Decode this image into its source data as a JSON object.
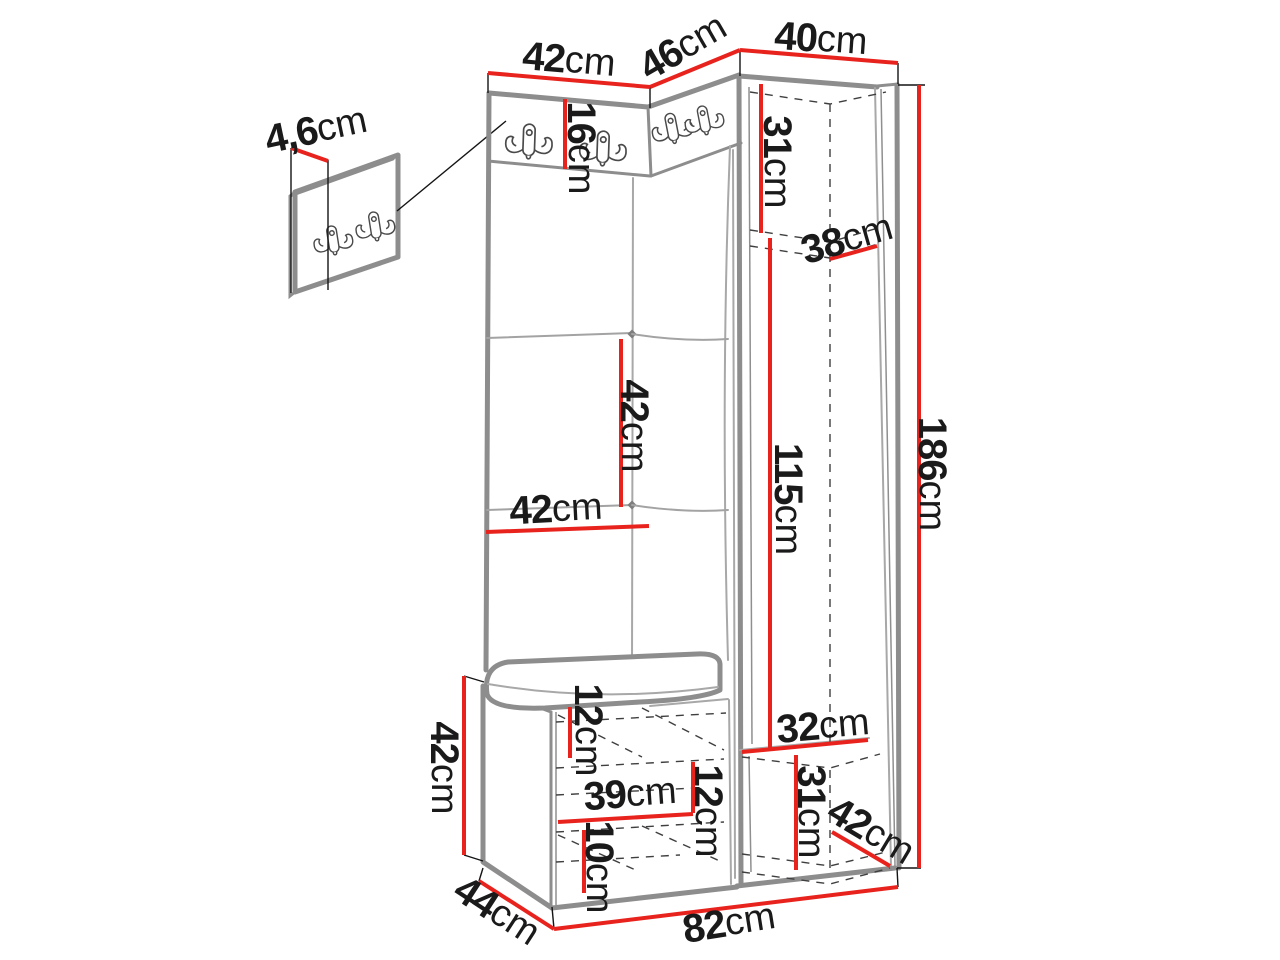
{
  "figure": {
    "kind": "furniture dimension diagram",
    "unit": "cm"
  },
  "colors": {
    "dimension_line": "#e8231e",
    "furniture_outline": "#8d8d8d",
    "dashed_hidden_edge": "#3f3f3f",
    "extension_line": "#141414",
    "label_text": "#1a1a1a",
    "background": "#ffffff"
  },
  "icons": [
    {
      "name": "double-coat-hook-icon",
      "count": 6
    }
  ],
  "dims": [
    {
      "id": "panel-thickness",
      "value": "4,6",
      "unit": "cm"
    },
    {
      "id": "top-width-left",
      "value": "42",
      "unit": "cm"
    },
    {
      "id": "top-width-angled",
      "value": "46",
      "unit": "cm"
    },
    {
      "id": "top-width-right",
      "value": "40",
      "unit": "cm"
    },
    {
      "id": "hook-strip-height",
      "value": "16",
      "unit": "cm"
    },
    {
      "id": "upper-shelf-height",
      "value": "31",
      "unit": "cm"
    },
    {
      "id": "shelf-depth",
      "value": "38",
      "unit": "cm"
    },
    {
      "id": "panel-section-height",
      "value": "42",
      "unit": "cm"
    },
    {
      "id": "panel-width",
      "value": "42",
      "unit": "cm"
    },
    {
      "id": "hanging-space-height",
      "value": "115",
      "unit": "cm"
    },
    {
      "id": "total-height",
      "value": "186",
      "unit": "cm"
    },
    {
      "id": "bench-height",
      "value": "42",
      "unit": "cm"
    },
    {
      "id": "bench-top-shelf-height",
      "value": "12",
      "unit": "cm"
    },
    {
      "id": "bench-inner-width",
      "value": "39",
      "unit": "cm"
    },
    {
      "id": "bench-middle-shelf-height",
      "value": "12",
      "unit": "cm"
    },
    {
      "id": "bench-bottom-shelf-height",
      "value": "10",
      "unit": "cm"
    },
    {
      "id": "lower-compartment-width",
      "value": "32",
      "unit": "cm"
    },
    {
      "id": "lower-compartment-height",
      "value": "31",
      "unit": "cm"
    },
    {
      "id": "lower-compartment-depth",
      "value": "42",
      "unit": "cm"
    },
    {
      "id": "bench-depth",
      "value": "44",
      "unit": "cm"
    },
    {
      "id": "total-width",
      "value": "82",
      "unit": "cm"
    }
  ]
}
